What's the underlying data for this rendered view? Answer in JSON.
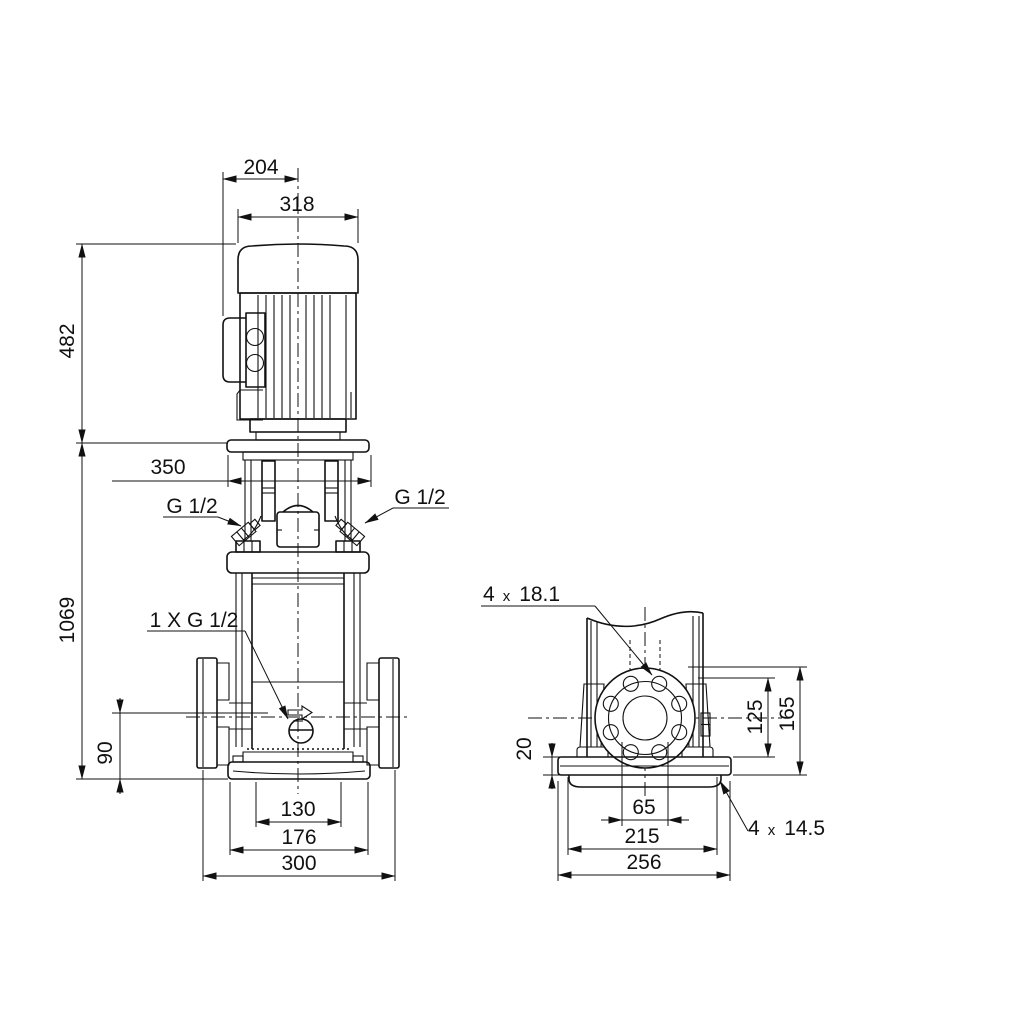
{
  "meta": {
    "background": "#ffffff",
    "line_color": "#111111",
    "description": "Dimensional outline drawing of a vertical multistage centrifugal pump, front view and side flange view"
  },
  "front_view": {
    "dims": {
      "motor_face_to_center": "204",
      "motor_width": "318",
      "motor_height": "482",
      "coupling_stool_width": "350",
      "total_height": "1069",
      "port_center_height": "90",
      "base_inner_width": "130",
      "base_outer_width": "176",
      "flange_to_flange": "300"
    },
    "labels": {
      "plug_left": "G 1/2",
      "plug_right": "G 1/2",
      "drain": "1 X G 1/2"
    }
  },
  "side_view": {
    "dims": {
      "base_plate_thickness": "20",
      "bolt_hole_height": "125",
      "flange_top_height": "165",
      "port_bore": "65",
      "base_hole_spacing": "215",
      "base_plate_width": "256"
    },
    "labels": {
      "flange_holes_count": "4",
      "flange_holes_sep": "x",
      "flange_holes_size": "18.1",
      "base_holes_count": "4",
      "base_holes_sep": "x",
      "base_holes_size": "14.5"
    }
  }
}
